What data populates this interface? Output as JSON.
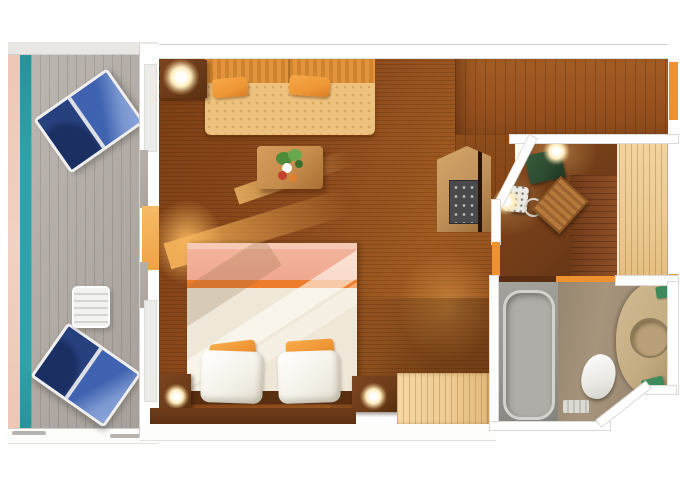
{
  "meta": {
    "title": "cruise-stateroom-floor-plan",
    "width_px": 680,
    "height_px": 486,
    "visible_text": []
  },
  "rooms": [
    {
      "id": "balcony"
    },
    {
      "id": "living-area"
    },
    {
      "id": "sleeping-area"
    },
    {
      "id": "entry-corridor"
    },
    {
      "id": "desk-nook"
    },
    {
      "id": "wardrobe"
    },
    {
      "id": "bathroom"
    }
  ],
  "furniture": [
    "deck-lounge-chair-upper",
    "deck-lounge-chair-lower",
    "balcony-side-table",
    "sofa-with-pillows",
    "coffee-table-with-plant",
    "corner-table-with-lamp",
    "double-bed-with-pillows",
    "nightstand-left",
    "nightstand-right",
    "dresser",
    "minibar-cabinet",
    "desk-blotter",
    "telephone",
    "wooden-desk-chair",
    "bathtub",
    "toilet",
    "vanity-with-sink",
    "green-towels"
  ],
  "colors": {
    "hull_pink": "#edc6b4",
    "railing_teal": "#2fa3ab",
    "deck_gray": "#b0a9a4",
    "trim_gray": "#e9e7e4",
    "wall_white": "#ffffff",
    "wall_edge": "#d2d0cd",
    "cabin_floor_dark": "#7c3f15",
    "cabin_floor": "#8d4a1c",
    "cabin_floor_light": "#a05b22",
    "corridor_floor": "#9a5320",
    "nook_floor": "#713c18",
    "desk_wood": "#7e4420",
    "wardrobe_wood": "#eccb93",
    "dresser_wood": "#eecb92",
    "sofa_back": "#e2953c",
    "sofa_back_stripe": "#d0842e",
    "sofa_seat": "#edc17e",
    "pillow_orange": "#ef9737",
    "bed_foot": "#f0a88f",
    "bed_foot_pale": "#f6c9b4",
    "bed_stripe": "#ee7c2d",
    "duvet": "#efe8d9",
    "pillow_white": "#f5f2e9",
    "headboard": "#5a2e11",
    "nightstand": "#6e3c1a",
    "table_dark": "#6b3a19",
    "lamp_glow": "#ffeebf",
    "chair_navy": "#27407e",
    "chair_blue": "#3f63b0",
    "chair_blue_light": "#7b97d0",
    "chair_frame": "#f0efed",
    "balcony_table_white": "#f2f2f0",
    "coffee_table": "#c68c4c",
    "plant_green": "#4e8c3a",
    "plant_green_light": "#6aa84e",
    "plant_red": "#c6402e",
    "plant_orange": "#e07f2e",
    "sun_beam": "#f6b45c",
    "door_orange": "#f0912f",
    "curtain_red": "#a83226",
    "bottom_wall": "#5d3113",
    "cabinet_tan": "#c0915a",
    "minibar_panel": "#4a4a4c",
    "blotter_green": "#2c4a30",
    "phone_white": "#eceae4",
    "desk_chair_wood": "#b5793c",
    "bath_floor": "#b9a58a",
    "tub_stall": "#94938d",
    "tub_fill": "#aeada7",
    "tub_edge": "#d3d2cc",
    "toilet_white": "#e9e8e3",
    "vanity_tan": "#c4ac83",
    "sink_tan": "#b9a078",
    "sink_rim": "#8d7a58",
    "towel_green": "#3f8a5c"
  }
}
